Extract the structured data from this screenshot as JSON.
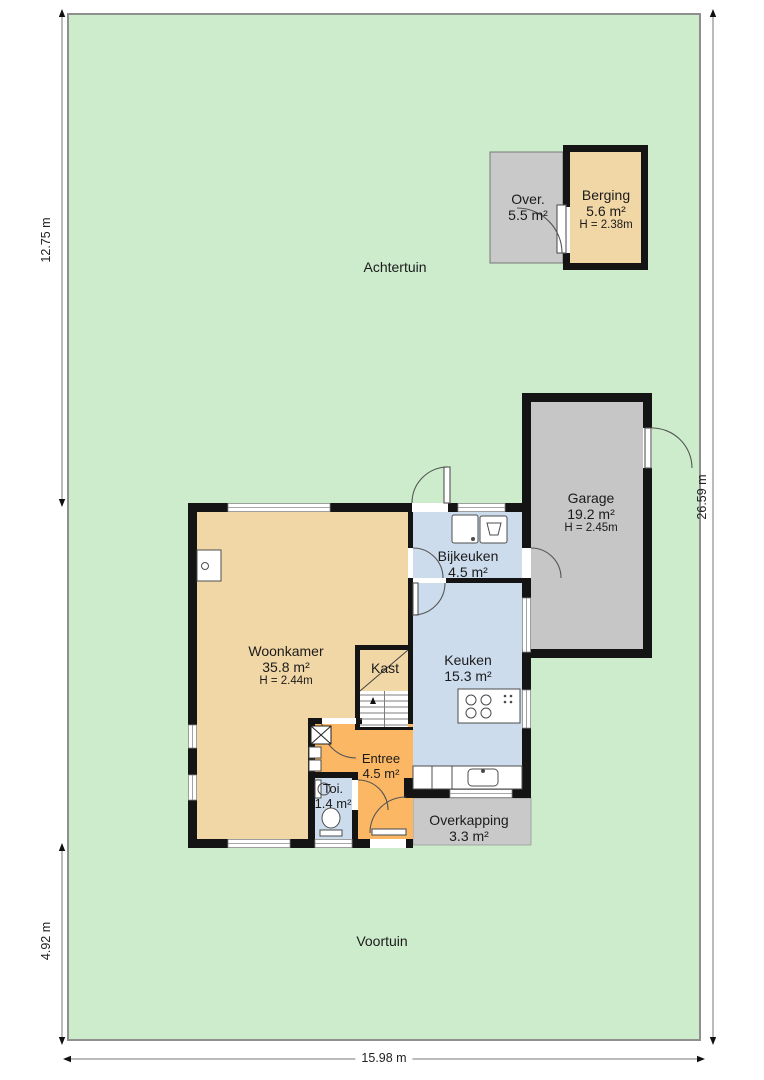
{
  "plan": {
    "garden": {
      "back": "Achtertuin",
      "front": "Voortuin"
    },
    "dimensions": {
      "left_upper": "12.75 m",
      "left_lower": "4.92 m",
      "right": "26.59 m",
      "bottom": "15.98 m"
    },
    "rooms": {
      "woonkamer": {
        "name": "Woonkamer",
        "area": "35.8 m²",
        "height": "H = 2.44m"
      },
      "bijkeuken": {
        "name": "Bijkeuken",
        "area": "4.5 m²"
      },
      "keuken": {
        "name": "Keuken",
        "area": "15.3 m²"
      },
      "kast": {
        "name": "Kast"
      },
      "entree": {
        "name": "Entree",
        "area": "4.5 m²"
      },
      "toilet": {
        "name": "Toi.",
        "area": "1.4 m²"
      },
      "garage": {
        "name": "Garage",
        "area": "19.2 m²",
        "height": "H = 2.45m"
      },
      "overkapping": {
        "name": "Overkapping",
        "area": "3.3 m²"
      },
      "overkapping_klein": {
        "name": "Over.",
        "area": "5.5 m²"
      },
      "berging": {
        "name": "Berging",
        "area": "5.6 m²",
        "height": "H = 2.38m"
      }
    },
    "colors": {
      "garden": "#cceccc",
      "living_tan": "#f2d7a6",
      "hall_orange": "#fbb763",
      "wet_blue": "#cddced",
      "garage_gray": "#c6c6c6",
      "wall": "#141414"
    }
  }
}
